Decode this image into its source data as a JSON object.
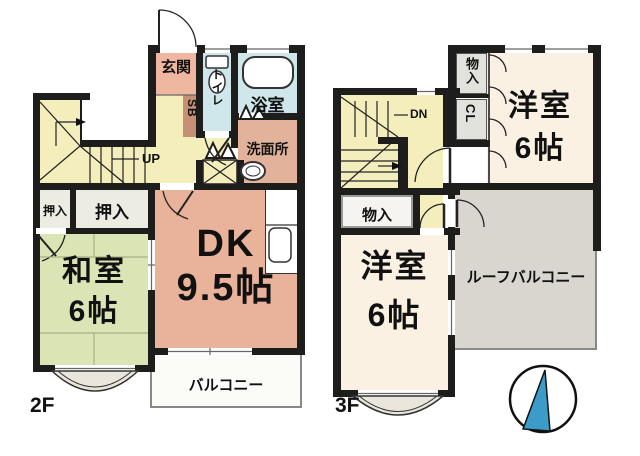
{
  "floor2": {
    "floor_label": "2F",
    "rooms": {
      "entrance": "玄関",
      "shoe_box": "SB",
      "toilet": "トイレ",
      "bathroom": "浴室",
      "washroom": "洗面所",
      "stairs": "UP",
      "closet_left": "押入",
      "closet_right": "押入",
      "japanese_room_name": "和室",
      "japanese_room_size": "6帖",
      "dining_kitchen_name": "DK",
      "dining_kitchen_size": "9.5帖",
      "balcony": "バルコニー"
    }
  },
  "floor3": {
    "floor_label": "3F",
    "rooms": {
      "storage_top": "物入",
      "closet": "CL",
      "stairs": "DN",
      "western_room_top_name": "洋室",
      "western_room_top_size": "6帖",
      "storage_mid": "物入",
      "western_room_bottom_name": "洋室",
      "western_room_bottom_size": "6帖",
      "roof_balcony": "ルーフバルコニー"
    }
  },
  "colors": {
    "wall": "#1d1d1b",
    "hall_yellow": "#f4eebc",
    "dk_salmon": "#e9b29a",
    "entrance_salmon": "#f0b7a0",
    "shoe_box_brown": "#c78f73",
    "washroom_tan": "#e2b39a",
    "wet_area_blue": "#cfe7ea",
    "tatami_green": "#dae4b5",
    "western_cream": "#faf1e3",
    "closet_gray": "#e2e2dc",
    "oshiire_gray": "#ecece3",
    "roof_balcony_gray": "#d9d6d0",
    "balcony_white": "#fbfbf8",
    "bay_window_fill": "#ebe6dc",
    "compass_blue": "#3b9cc9"
  }
}
